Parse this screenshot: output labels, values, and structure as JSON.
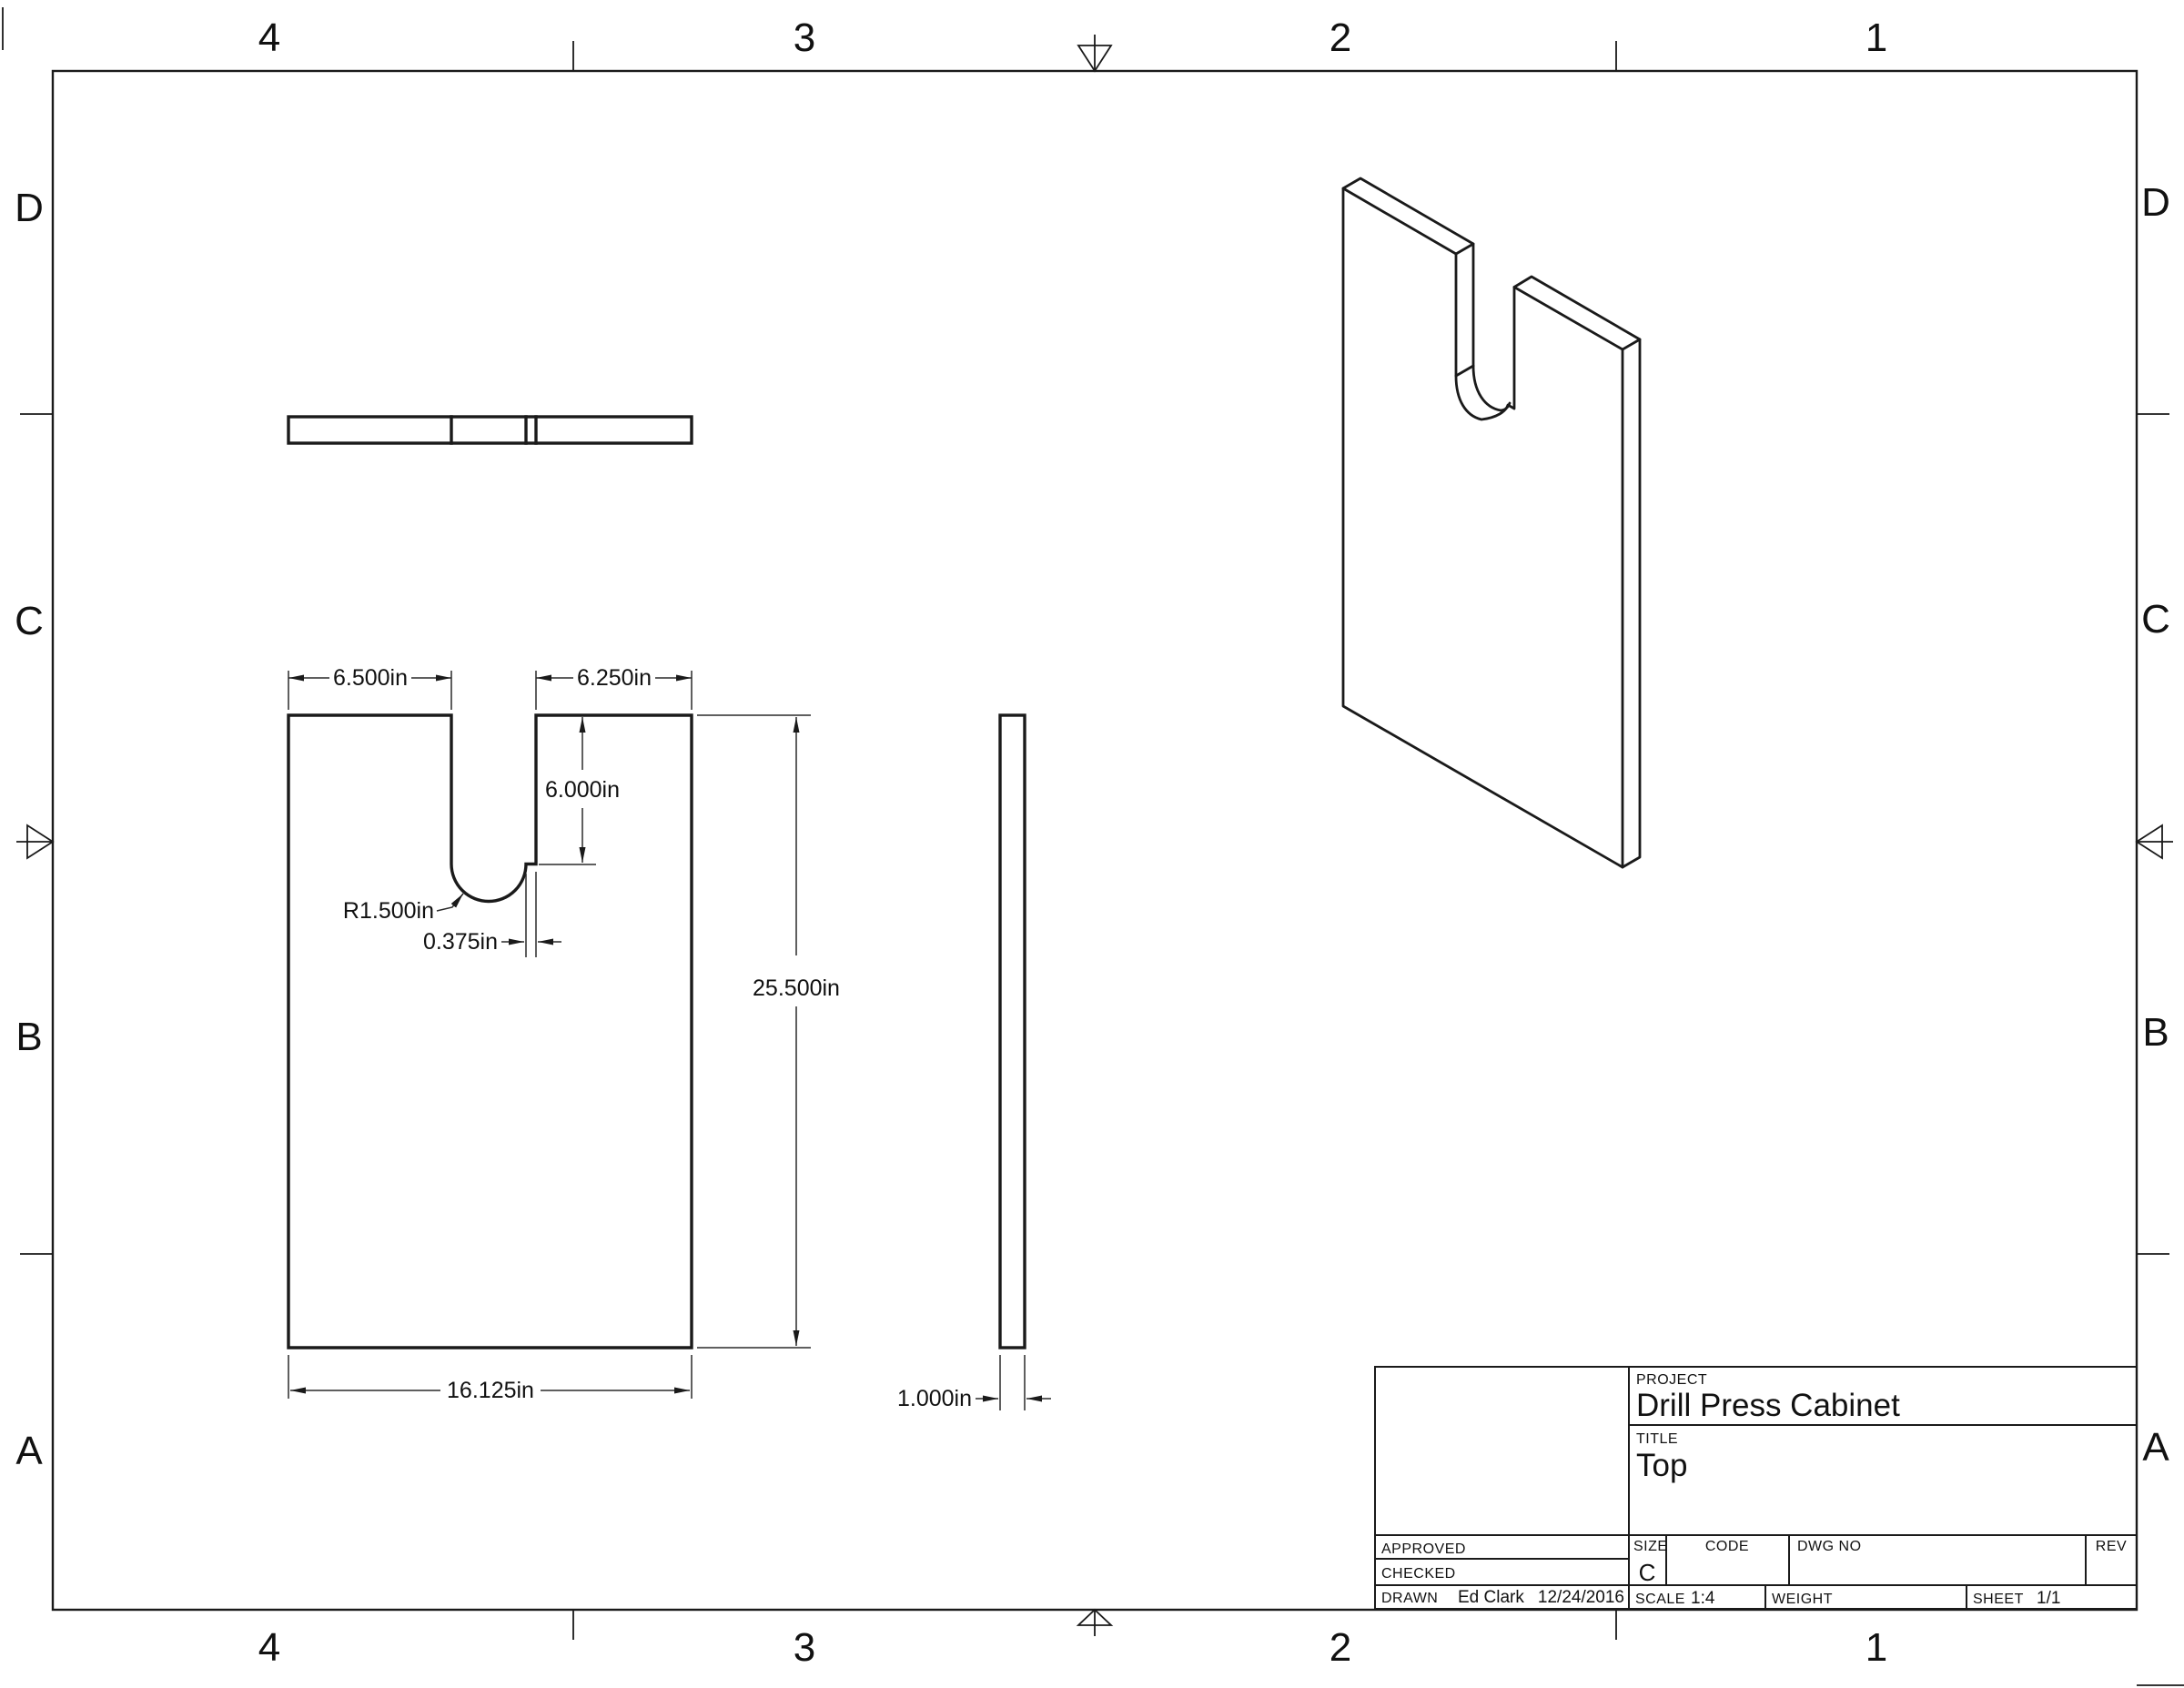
{
  "sheet": {
    "zones_top": [
      "4",
      "3",
      "2",
      "1"
    ],
    "zones_bottom": [
      "4",
      "3",
      "2",
      "1"
    ],
    "zones_left": [
      "D",
      "C",
      "B",
      "A"
    ],
    "zones_right": [
      "D",
      "C",
      "B",
      "A"
    ],
    "line_color": "#1a1a1a",
    "background": "#ffffff"
  },
  "views": {
    "front_view": {
      "name": "front-view",
      "dims": {
        "top_left_width": "6.500in",
        "top_right_width": "6.250in",
        "slot_depth": "6.000in",
        "slot_radius": "R1.500in",
        "step_width": "0.375in",
        "overall_height": "25.500in",
        "overall_width": "16.125in"
      }
    },
    "side_view": {
      "name": "side-view",
      "dims": {
        "thickness": "1.000in"
      }
    }
  },
  "title_block": {
    "project_label": "PROJECT",
    "project": "Drill Press Cabinet",
    "title_label": "TITLE",
    "title": "Top",
    "approved_label": "APPROVED",
    "checked_label": "CHECKED",
    "drawn_label": "DRAWN",
    "drawn_by": "Ed Clark",
    "drawn_date": "12/24/2016",
    "size_label": "SIZE",
    "size": "C",
    "code_label": "CODE",
    "dwg_no_label": "DWG NO",
    "rev_label": "REV",
    "scale_label": "SCALE",
    "scale": "1:4",
    "weight_label": "WEIGHT",
    "sheet_label": "SHEET",
    "sheet": "1/1"
  }
}
